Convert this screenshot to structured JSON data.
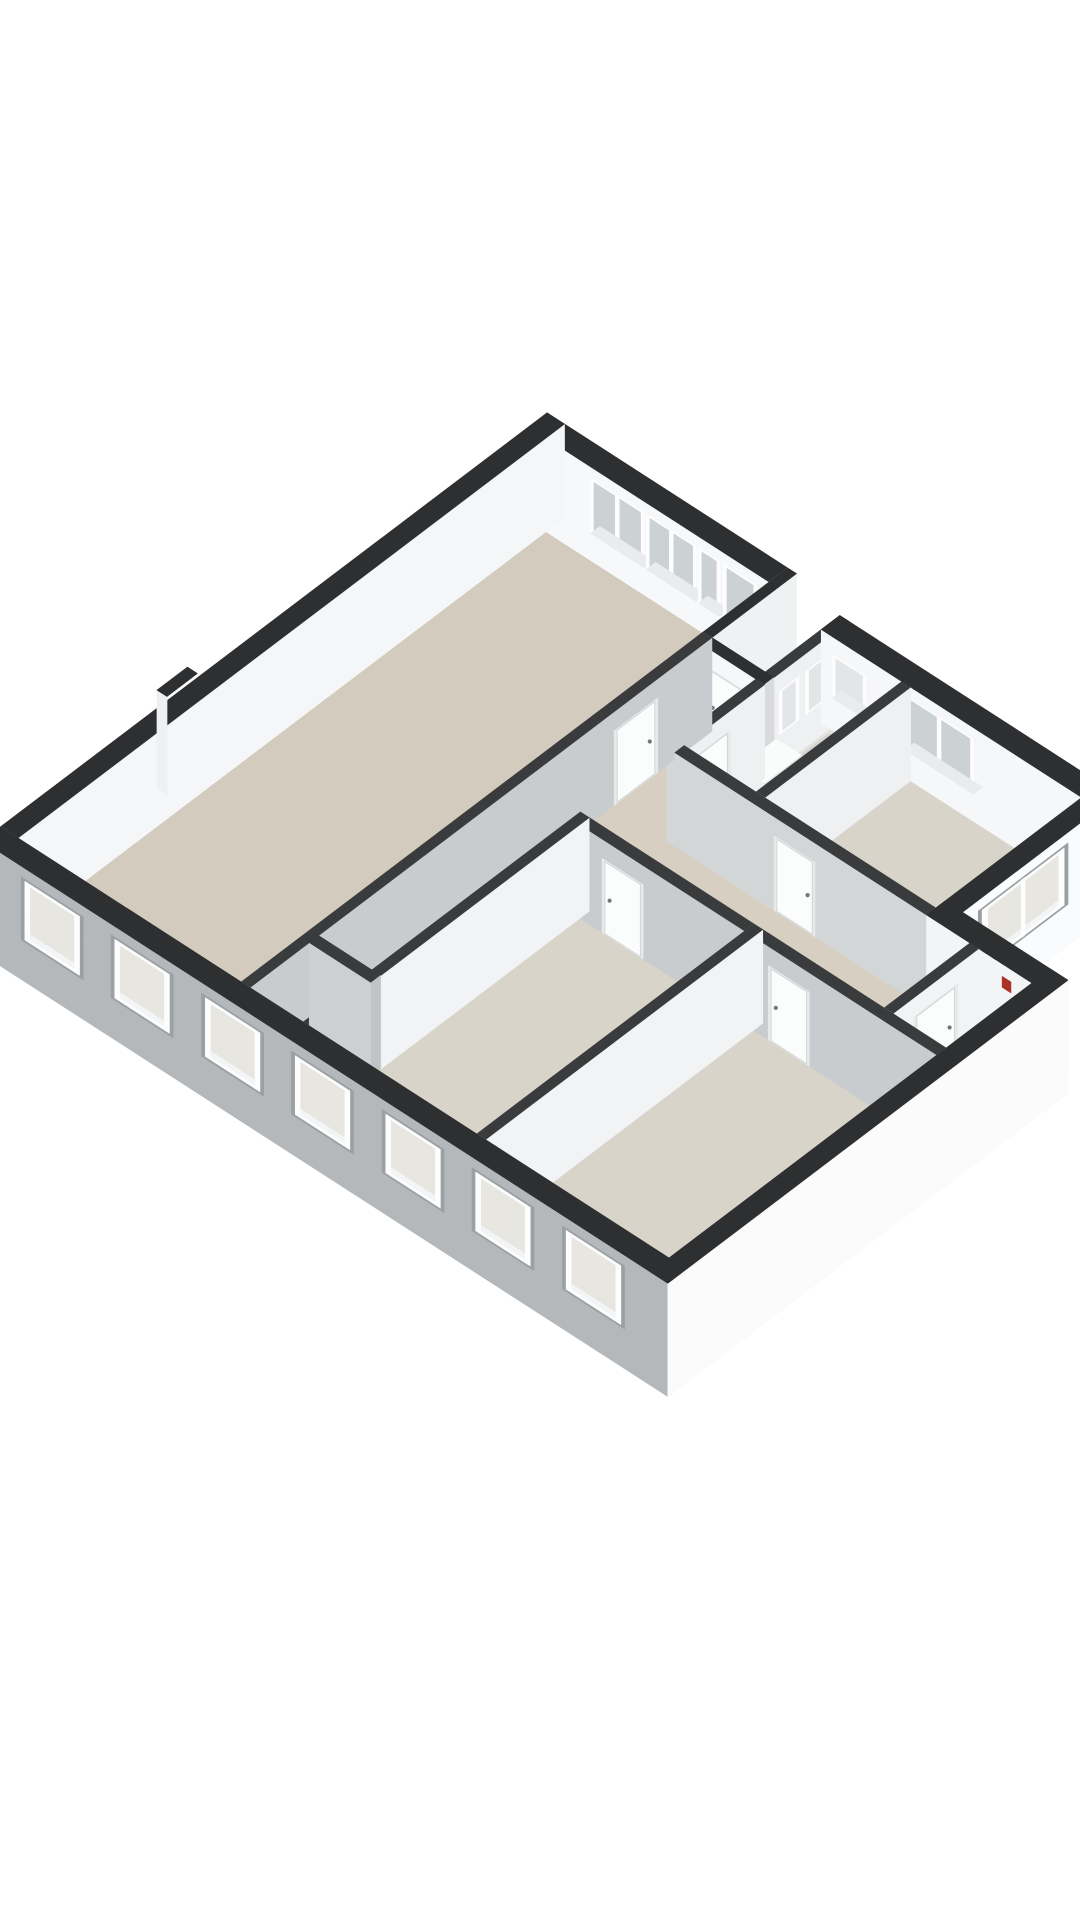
{
  "page": {
    "title": "3d-floor-plan-render",
    "background": "#ffffff"
  },
  "rooms": [
    {
      "id": "living-room"
    },
    {
      "id": "hallway"
    },
    {
      "id": "closet"
    },
    {
      "id": "corridor"
    },
    {
      "id": "bathroom"
    },
    {
      "id": "bedroom-right"
    },
    {
      "id": "bedroom-a"
    },
    {
      "id": "bedroom-b"
    },
    {
      "id": "storage"
    }
  ],
  "scene": {
    "canvas": {
      "width": 1080,
      "height": 1920,
      "background": "#ffffff"
    },
    "projection": {
      "ox": 18,
      "oy": 931.6,
      "ux": 62,
      "uy": 40,
      "vx": 66,
      "vy": -50,
      "hz": 36,
      "wall_height": 2.6
    },
    "palette": {
      "top_ext": "#2e2f31",
      "top_int": "#3a3b3d",
      "facade": "#b5b8bb",
      "reveal": "#9aa0a3",
      "frame": "#fdfdfe",
      "recess": "#e7e9ea",
      "leaf": "#fbfcfc",
      "leaf_stroke": "#c9ccce",
      "handle": "#74777a",
      "sill": "#e9ebed",
      "glass_cool": "#ccd1d4",
      "glass_warm": "#e8e6e0",
      "glass_frost": "#e3e6e7",
      "red_marker": "#ab3226",
      "vent": "#313234"
    },
    "floors": [
      {
        "name": "floor-living-room",
        "poly": [
          [
            0,
            0
          ],
          [
            0,
            8.0
          ],
          [
            3.6,
            8.0
          ],
          [
            3.6,
            0
          ]
        ],
        "fill": "#d3cbbd"
      },
      {
        "name": "floor-hallway",
        "poly": [
          [
            3.6,
            0.9
          ],
          [
            3.6,
            7.0
          ],
          [
            4.6,
            7.0
          ],
          [
            4.6,
            0.9
          ]
        ],
        "fill": "#d6cfc2"
      },
      {
        "name": "floor-closet",
        "poly": [
          [
            3.6,
            0
          ],
          [
            3.6,
            0.9
          ],
          [
            4.6,
            0.9
          ],
          [
            4.6,
            0
          ]
        ],
        "fill": "#d6cfc2"
      },
      {
        "name": "floor-corridor",
        "poly": [
          [
            4.6,
            4.2
          ],
          [
            4.6,
            5.5
          ],
          [
            9.5,
            5.5
          ],
          [
            9.5,
            4.2
          ]
        ],
        "fill": "#d6cfc2"
      },
      {
        "name": "floor-bathroom",
        "poly": [
          [
            4.6,
            5.5
          ],
          [
            4.6,
            7.85
          ],
          [
            5.9,
            7.85
          ],
          [
            5.9,
            5.5
          ]
        ],
        "fill": "#e2e0da"
      },
      {
        "name": "floor-bedroom-a",
        "poly": [
          [
            4.6,
            0
          ],
          [
            4.6,
            4.2
          ],
          [
            7.4,
            4.2
          ],
          [
            7.4,
            0
          ]
        ],
        "fill": "#d9d4ca"
      },
      {
        "name": "floor-bedroom-b",
        "poly": [
          [
            7.4,
            0
          ],
          [
            7.4,
            4.2
          ],
          [
            10.5,
            4.2
          ],
          [
            10.5,
            0
          ]
        ],
        "fill": "#d9d4ca"
      },
      {
        "name": "floor-bedroom-right",
        "poly": [
          [
            5.9,
            5.5
          ],
          [
            5.9,
            7.85
          ],
          [
            8.8,
            7.85
          ],
          [
            8.8,
            5.5
          ]
        ],
        "fill": "#d9d4ca"
      },
      {
        "name": "floor-storage",
        "poly": [
          [
            9.5,
            4.2
          ],
          [
            9.5,
            5.5
          ],
          [
            10.5,
            5.5
          ],
          [
            10.5,
            4.2
          ]
        ],
        "fill": "#d7d2c8"
      }
    ],
    "floor_overlays": [
      {
        "name": "shower-tray",
        "u0": 4.78,
        "u1": 5.56,
        "v0": 7.24,
        "v1": 7.8,
        "fill": "#d4d4d0",
        "border": "#e9e9e6",
        "dots": "#c2c2bd",
        "dot_rows": 4,
        "dot_cols": 6
      }
    ],
    "walls": [
      {
        "name": "wall-ne-living-band",
        "axis": "u",
        "u0": 0,
        "u1": 3.6,
        "v0": 8.0,
        "v1": 8.28,
        "zb": 0,
        "top": "#2e2f31",
        "face": "#f7f8f9",
        "cap": "#d8dadc",
        "windows": [
          {
            "a0": 0.72,
            "a1": 1.58,
            "z0": 0.75,
            "z1": 2.28,
            "style": "int",
            "glass": "#ccd1d4",
            "panes": 2,
            "sill": true
          },
          {
            "a0": 1.62,
            "a1": 2.42,
            "z0": 0.75,
            "z1": 2.28,
            "style": "int",
            "glass": "#ccd1d4",
            "panes": 2,
            "sill": true
          },
          {
            "a0": 2.46,
            "a1": 2.8,
            "z0": 0.75,
            "z1": 2.28,
            "style": "int",
            "glass": "#ccd1d4",
            "panes": 1,
            "sill": true
          }
        ],
        "doors": [
          {
            "a0": 2.86,
            "a1": 3.4,
            "style": "glassdoor",
            "glass": "#ccd1d4",
            "handle": "a1"
          }
        ]
      },
      {
        "name": "wall-nw-exterior",
        "axis": "v",
        "u0": -0.28,
        "u1": 0,
        "v0": 0,
        "v1": 8.28,
        "zb": 0,
        "top": "#2e2f31",
        "face": "#f5f6f8",
        "cap": "#c6c9cb"
      },
      {
        "name": "wall-sw-facade",
        "axis": "u",
        "u0": -0.28,
        "u1": 10.78,
        "v0": -0.28,
        "v1": 0,
        "zb": -0.55,
        "top": "#2e2f31",
        "face": "#b5b8bb",
        "cap": "#e2e4e6",
        "windows": [
          {
            "a0": 0.35,
            "a1": 1.35,
            "z0": 0.55,
            "z1": 2.3,
            "style": "ext",
            "glass": "#e8e6e0",
            "panes": 1
          },
          {
            "a0": 1.8,
            "a1": 2.8,
            "z0": 0.55,
            "z1": 2.3,
            "style": "ext",
            "glass": "#e8e6e0",
            "panes": 1
          },
          {
            "a0": 3.26,
            "a1": 4.26,
            "z0": 0.55,
            "z1": 2.3,
            "style": "ext",
            "glass": "#e8e6e0",
            "panes": 1
          },
          {
            "a0": 4.71,
            "a1": 5.71,
            "z0": 0.55,
            "z1": 2.3,
            "style": "ext",
            "glass": "#e8e6e0",
            "panes": 1
          },
          {
            "a0": 6.17,
            "a1": 7.17,
            "z0": 0.55,
            "z1": 2.3,
            "style": "ext",
            "glass": "#e8e6e0",
            "panes": 1
          },
          {
            "a0": 7.62,
            "a1": 8.62,
            "z0": 0.55,
            "z1": 2.3,
            "style": "ext",
            "glass": "#e8e6e0",
            "panes": 1
          },
          {
            "a0": 9.08,
            "a1": 10.08,
            "z0": 0.55,
            "z1": 2.3,
            "style": "ext",
            "glass": "#e8e6e0",
            "panes": 1
          }
        ]
      },
      {
        "name": "wall-se-end-exterior",
        "axis": "v",
        "u0": 10.5,
        "u1": 10.78,
        "v0": -0.28,
        "v1": 5.78,
        "zb": -0.55,
        "top": "#2e2f31",
        "face": "#fbfbfc",
        "cap": null
      },
      {
        "name": "wall-storage-ne",
        "axis": "u",
        "u0": 8.8,
        "u1": 10.78,
        "v0": 5.5,
        "v1": 5.78,
        "zb": 0,
        "top": "#2e2f31",
        "face": "#f3f4f6",
        "cap": "#d8dadc",
        "marks": [
          {
            "a0": 10.02,
            "a1": 10.16,
            "z0": 1.95,
            "z1": 2.25,
            "fill": "#ab3226"
          },
          {
            "a0": 9.7,
            "a1": 9.78,
            "z0": 2.6,
            "z1": 2.78,
            "fill": "#313234"
          },
          {
            "a0": 9.84,
            "a1": 9.92,
            "z0": 2.6,
            "z1": 2.76,
            "fill": "#313234"
          },
          {
            "a0": 9.98,
            "a1": 10.04,
            "z0": 2.6,
            "z1": 2.74,
            "fill": "#313234"
          }
        ]
      },
      {
        "name": "wall-block-ne",
        "axis": "u",
        "u0": 4.6,
        "u1": 9.08,
        "v0": 7.85,
        "v1": 8.13,
        "zb": 0,
        "top": "#2e2f31",
        "face": "#f6f7f9",
        "cap": "#d8dadc",
        "windows": [
          {
            "a0": 4.78,
            "a1": 5.32,
            "z0": 0.9,
            "z1": 2.1,
            "style": "frost",
            "glass": "#e3e6e7",
            "panes": 1,
            "sill": true
          },
          {
            "a0": 5.95,
            "a1": 7.05,
            "z0": 0.75,
            "z1": 2.28,
            "style": "int",
            "glass": "#ccd1d4",
            "panes": 2,
            "sill": true
          }
        ]
      },
      {
        "name": "wall-bedroom-right-se",
        "axis": "v",
        "u0": 8.8,
        "u1": 9.08,
        "v0": 5.5,
        "v1": 8.13,
        "zb": -0.55,
        "top": "#2e2f31",
        "face": "#fafbfc",
        "cap": "#dddfe1",
        "windows": [
          {
            "a0": 6.02,
            "a1": 7.38,
            "z0": 0.6,
            "z1": 2.3,
            "style": "ext",
            "glass": "#e8e6e0",
            "panes": 2
          }
        ]
      },
      {
        "name": "wall-notch-west",
        "axis": "v",
        "u0": 3.6,
        "u1": 3.74,
        "v0": 7.0,
        "v1": 8.28,
        "zb": 0,
        "top": "#2e2f31",
        "face": "#eff1f3",
        "cap": "#d4d6d8"
      },
      {
        "name": "wall-notch-south",
        "axis": "u",
        "u0": 3.6,
        "u1": 4.74,
        "v0": 6.86,
        "v1": 7.0,
        "zb": 0,
        "top": "#2e2f31",
        "face": "#f6f7f9",
        "cap": "#d8dadc",
        "doors": [
          {
            "a0": 3.78,
            "a1": 4.44,
            "style": "panel",
            "handle": "a0"
          }
        ]
      },
      {
        "name": "wall-bathroom-west-north",
        "axis": "v",
        "u0": 4.6,
        "u1": 4.74,
        "v0": 6.86,
        "v1": 8.13,
        "zb": 0,
        "top": "#3a3b3d",
        "face": "#eef0f2",
        "cap": null,
        "windows": [
          {
            "a0": 7.08,
            "a1": 7.38,
            "z0": 0.9,
            "z1": 2.1,
            "style": "frost",
            "glass": "#e3e6e7",
            "panes": 1
          },
          {
            "a0": 7.48,
            "a1": 7.78,
            "z0": 0.9,
            "z1": 2.1,
            "style": "frost",
            "glass": "#e3e6e7",
            "panes": 1
          }
        ]
      },
      {
        "name": "wall-living-hall",
        "axis": "v",
        "u0": 3.6,
        "u1": 3.74,
        "v0": 0,
        "v1": 7.0,
        "zb": 0,
        "top": "#3a3b3d",
        "face": "#c9ccce",
        "cap": "#b9bcbe",
        "doors": [
          {
            "a0": 5.52,
            "a1": 6.18,
            "style": "panel",
            "handle": "a1"
          }
        ]
      },
      {
        "name": "wall-closet-north",
        "axis": "u",
        "u0": 3.74,
        "u1": 4.74,
        "v0": 0.9,
        "v1": 1.04,
        "zb": 0,
        "top": "#3a3b3d",
        "face": "#cdd0d2",
        "cap": "#c1c4c6"
      },
      {
        "name": "wall-bedroom-a-west",
        "axis": "v",
        "u0": 4.6,
        "u1": 4.74,
        "v0": 0,
        "v1": 4.2,
        "zb": 0,
        "top": "#3a3b3d",
        "face": "#f2f3f5",
        "cap": "#d8dadc"
      },
      {
        "name": "wall-bedroom-a-north",
        "axis": "u",
        "u0": 4.74,
        "u1": 7.4,
        "v0": 4.06,
        "v1": 4.2,
        "zb": 0,
        "top": "#3a3b3d",
        "face": "#c9ccce",
        "cap": "#bdc0c2",
        "doors": [
          {
            "a0": 5.1,
            "a1": 5.76,
            "style": "panel",
            "handle": "a0"
          }
        ]
      },
      {
        "name": "wall-bedroom-b-north",
        "axis": "u",
        "u0": 7.54,
        "u1": 10.5,
        "v0": 4.06,
        "v1": 4.2,
        "zb": 0,
        "top": "#3a3b3d",
        "face": "#c9ccce",
        "cap": "#bdc0c2",
        "doors": [
          {
            "a0": 7.78,
            "a1": 8.44,
            "style": "panel",
            "handle": "a0"
          }
        ]
      },
      {
        "name": "wall-bedroom-a-b-divider",
        "axis": "v",
        "u0": 7.4,
        "u1": 7.54,
        "v0": 0,
        "v1": 4.2,
        "zb": 0,
        "top": "#3a3b3d",
        "face": "#f2f3f5",
        "cap": "#d8dadc"
      },
      {
        "name": "wall-corridor-north",
        "axis": "u",
        "u0": 4.74,
        "u1": 8.8,
        "v0": 5.5,
        "v1": 5.64,
        "zb": 0,
        "top": "#3a3b3d",
        "face": "#d3d6d7",
        "cap": "#c5c8ca",
        "doors": [
          {
            "a0": 6.34,
            "a1": 7.0,
            "style": "panel",
            "handle": "a1"
          }
        ]
      },
      {
        "name": "wall-bath-bedroom-divider",
        "axis": "v",
        "u0": 5.9,
        "u1": 6.04,
        "v0": 5.64,
        "v1": 7.85,
        "zb": 0,
        "top": "#3a3b3d",
        "face": "#eef0f2",
        "cap": "#d4d6d8"
      },
      {
        "name": "wall-bathroom-west-south",
        "axis": "v",
        "u0": 4.6,
        "u1": 4.74,
        "v0": 5.5,
        "v1": 6.86,
        "zb": 0,
        "top": "#3a3b3d",
        "face": "#eef0f2",
        "cap": "#d4d6d8",
        "doors": [
          {
            "a0": 5.68,
            "a1": 6.34,
            "style": "panel",
            "handle": "a0"
          }
        ]
      },
      {
        "name": "wall-storage-west",
        "axis": "v",
        "u0": 9.5,
        "u1": 9.64,
        "v0": 4.2,
        "v1": 5.5,
        "zb": 0,
        "top": "#3a3b3d",
        "face": "#f2f3f5",
        "cap": "#d8dadc",
        "doors": [
          {
            "a0": 4.52,
            "a1": 5.18,
            "style": "panel",
            "handle": "a1"
          }
        ]
      }
    ],
    "boxes": [
      {
        "name": "chimney",
        "u0": -0.44,
        "u1": -0.28,
        "v0": 2.52,
        "v1": 2.98,
        "z0": 0,
        "z1": 2.72,
        "top": "#2e2f31",
        "face_v": "#eef0f2",
        "cap_u": null
      },
      {
        "name": "bathroom-sink",
        "u0": 4.74,
        "u1": 5.14,
        "v0": 6.48,
        "v1": 7.04,
        "z0": 0,
        "z1": 0.84,
        "top": "#fafbfb",
        "face_v": "#eceeef",
        "cap_u": "#dfe1e3"
      }
    ]
  }
}
